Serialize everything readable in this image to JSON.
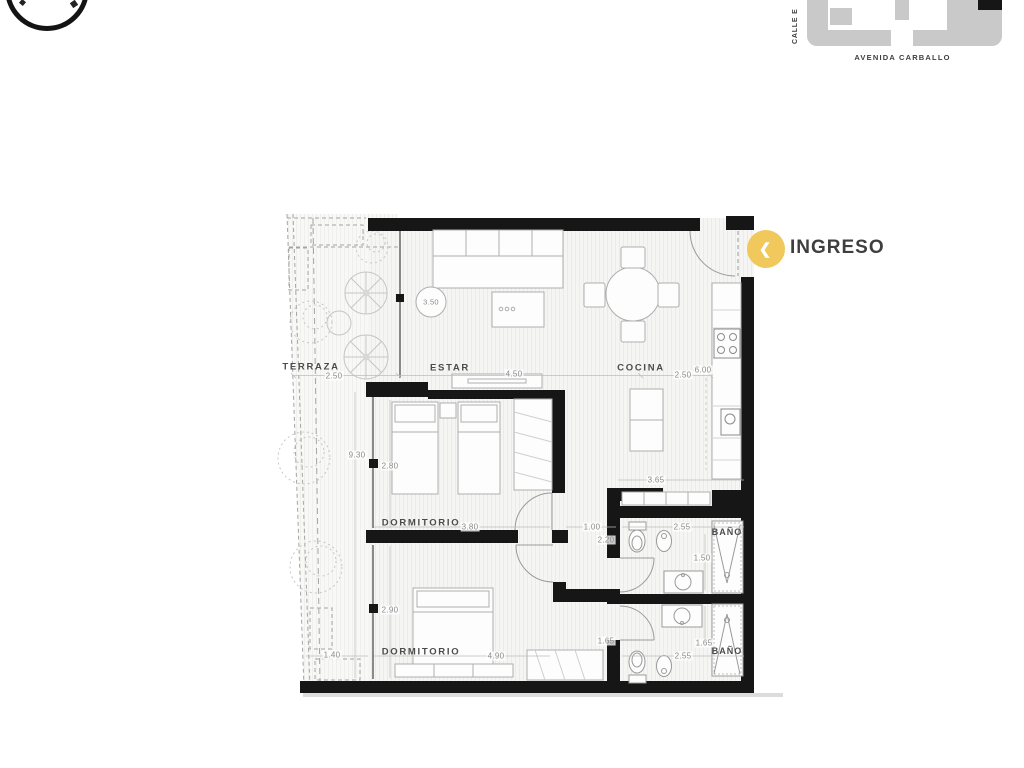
{
  "site_map": {
    "street_left": "CALLE E",
    "street_bottom": "AVENIDA CARBALLO"
  },
  "entry": {
    "label": "INGRESO",
    "icon": "chevron-left-icon",
    "accent_color": "#F0C85C"
  },
  "rooms": {
    "terraza": {
      "name": "TERRAZA"
    },
    "estar": {
      "name": "ESTAR"
    },
    "cocina": {
      "name": "COCINA"
    },
    "dormitorio_1": {
      "name": "DORMITORIO"
    },
    "dormitorio_2": {
      "name": "DORMITORIO"
    },
    "bano_1": {
      "name": "BAÑO"
    },
    "bano_2": {
      "name": "BAÑO"
    }
  },
  "dimensions": {
    "terraza_width": "2.50",
    "terraza_length": "9.30",
    "terraza_end_width": "1.40",
    "estar_width": "4.50",
    "ceiling_height": "3.50",
    "cocina_width": "2.50",
    "cocina_length": "6.00",
    "cocina_counter": "3.65",
    "dorm1_depth": "2.80",
    "dorm1_width": "3.80",
    "dorm2_depth": "2.90",
    "dorm2_width": "4.90",
    "hall_width": "1.00",
    "hall_length": "2.20",
    "hall_passage": "1.65",
    "bano1_width": "2.55",
    "bano1_depth": "1.50",
    "bano2_width": "2.55",
    "bano2_depth": "1.65"
  },
  "colors": {
    "wall": "#161616",
    "site_gray": "#c9c9c9",
    "accent_yellow": "#F0C85C"
  }
}
